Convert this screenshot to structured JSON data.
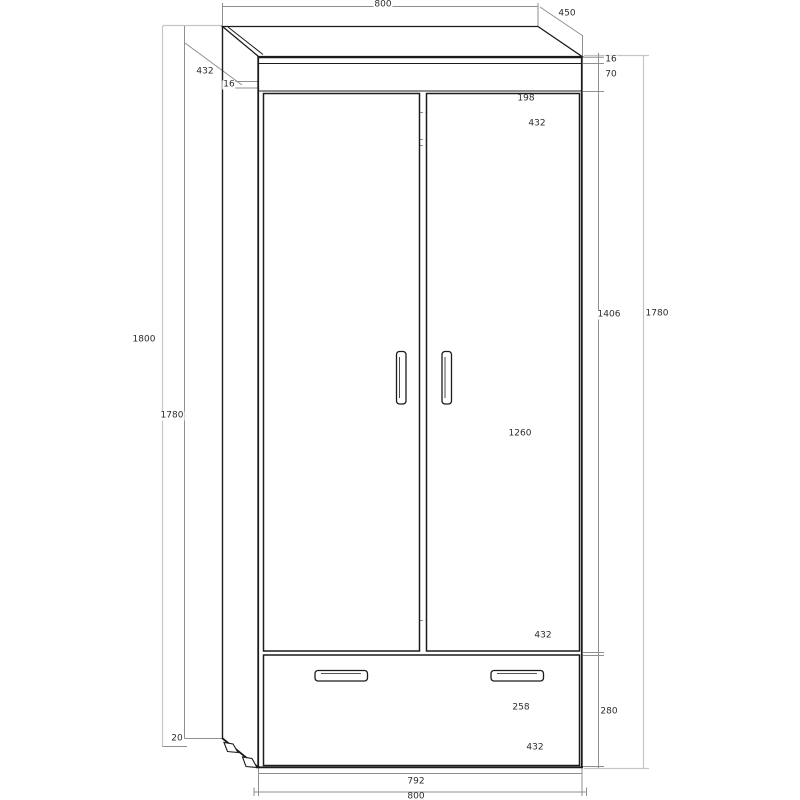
{
  "drawing": {
    "colors": {
      "background": "#ffffff",
      "outline": "#1c1c1c",
      "dimension_line": "#8f8f8f",
      "light_dimension_line": "#c6c6c6",
      "label_text": "#2b2b2b"
    },
    "dims": {
      "top_width": "800",
      "top_depth": "450",
      "side_depth": "432",
      "side_thickness": "16",
      "top_board_thickness": "16",
      "crown_height": "70",
      "rail_offset": "198",
      "rail_depth": "432",
      "door_height": "1406",
      "front_height": "1780",
      "interior_height": "1260",
      "shelf_depth": "432",
      "drawer_inner_height": "258",
      "drawer_front_height": "280",
      "drawer_depth": "432",
      "total_height": "1800",
      "side_height": "1780",
      "foot_height": "20",
      "drawer_width": "792",
      "bottom_width": "800"
    }
  }
}
